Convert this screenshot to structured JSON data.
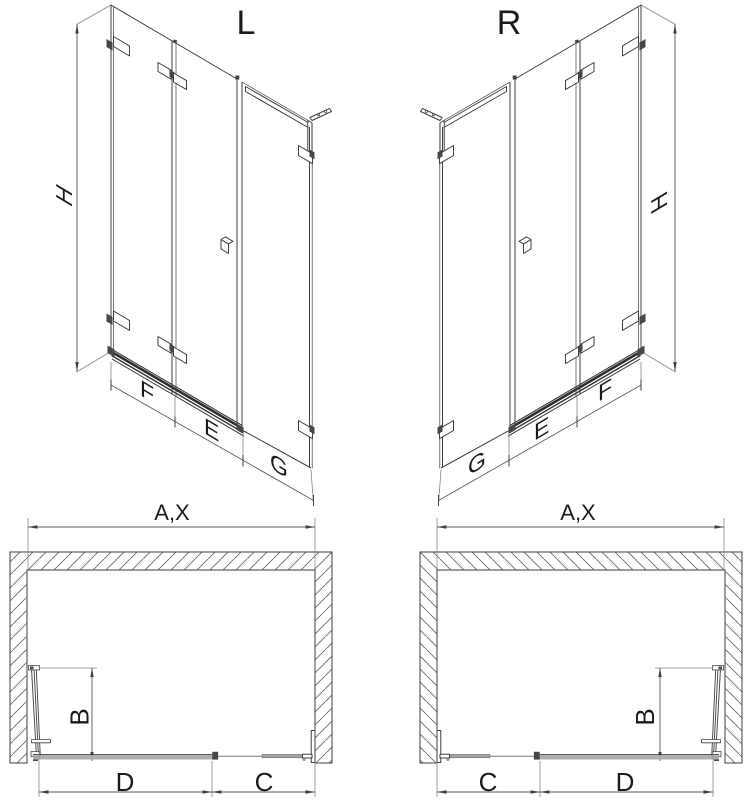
{
  "drawing": {
    "kind": "shower-screen-technical-diagram",
    "views": {
      "iso_left": {
        "title": "L",
        "h_label": "H",
        "f_label": "F",
        "e_label": "E",
        "g_label": "G"
      },
      "iso_right": {
        "title": "R",
        "h_label": "H",
        "f_label": "F",
        "e_label": "E",
        "g_label": "G"
      },
      "plan_left": {
        "width_label": "A,X",
        "b_label": "B",
        "c_label": "C",
        "d_label": "D"
      },
      "plan_right": {
        "width_label": "A,X",
        "b_label": "B",
        "c_label": "C",
        "d_label": "D"
      }
    },
    "colors": {
      "line": "#3f3f3f",
      "dim_line": "#5a5a5a",
      "rail_gray": "#adadad",
      "text": "#1a1a1a",
      "background": "#ffffff"
    }
  }
}
